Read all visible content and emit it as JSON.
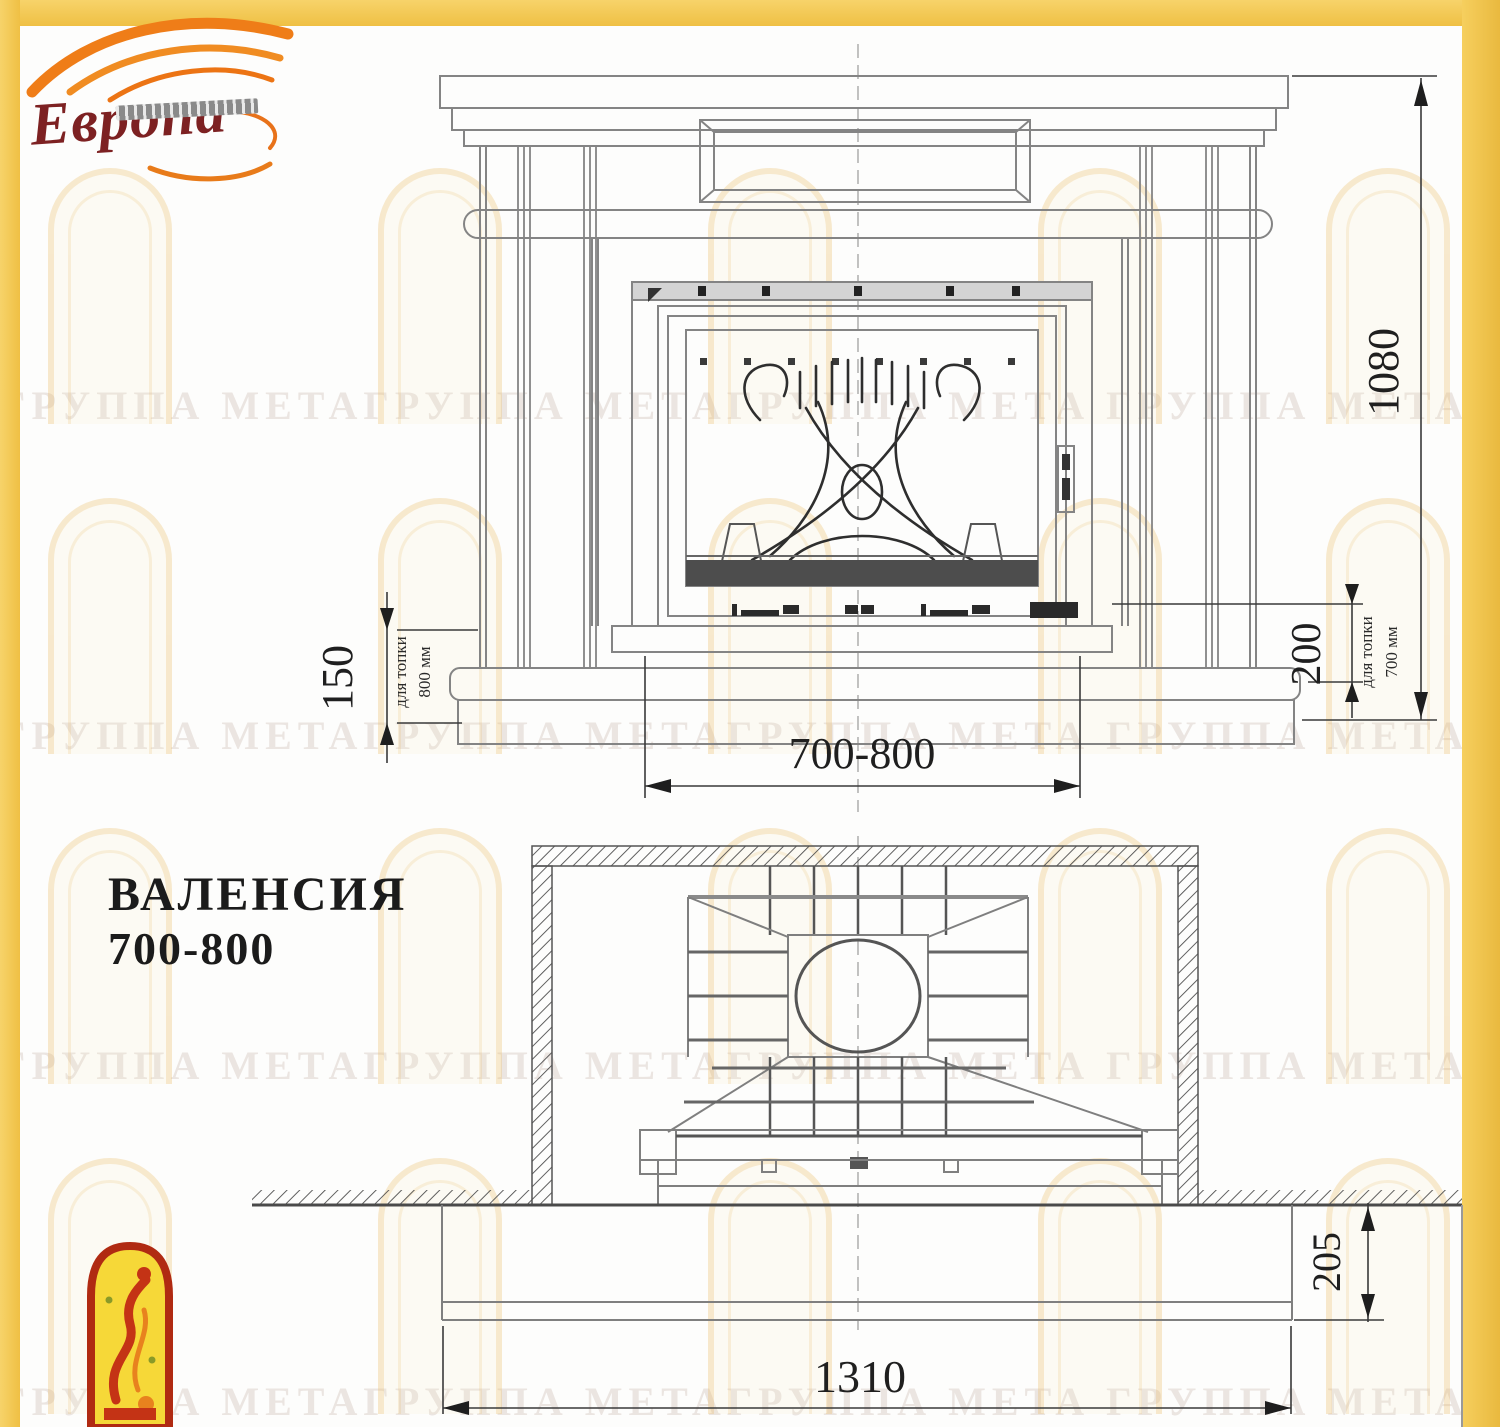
{
  "logo": {
    "name": "Европа"
  },
  "title": {
    "line1": "ВАЛЕНСИЯ",
    "line2": "700-800"
  },
  "front_view": {
    "dim_height": "1080",
    "dim_base_height": "150",
    "dim_firebox_offset": "200",
    "dim_width": "700-800",
    "note_left_line1": "для топки",
    "note_left_line2": "800 мм",
    "note_right_line1": "для топки",
    "note_right_line2": "700 мм"
  },
  "plan_view": {
    "dim_width": "1310",
    "dim_depth": "205"
  },
  "watermark": {
    "text": "ГРУППА МЕТАГРУППА МЕТАГРУППА МЕТА "
  }
}
